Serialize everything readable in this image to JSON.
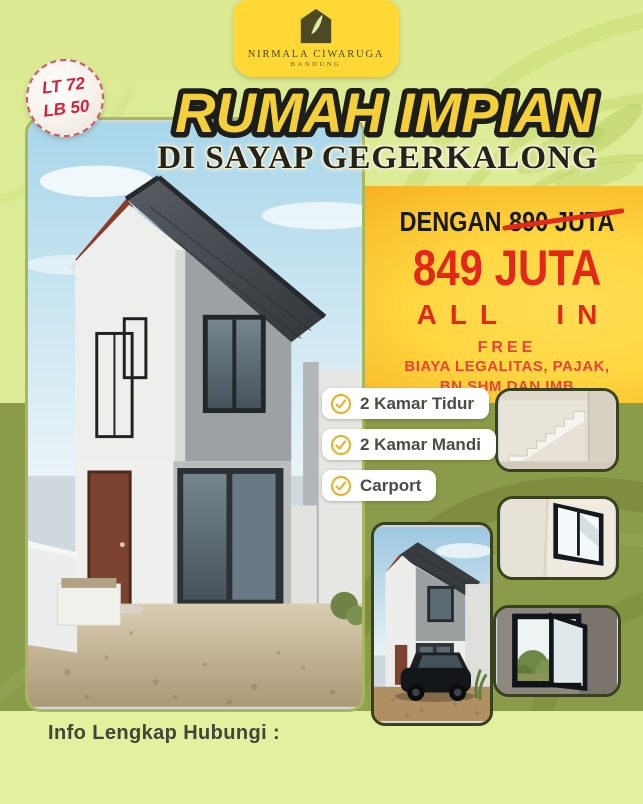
{
  "poster": {
    "badge": {
      "line1": "LT 72",
      "line2": "LB 50"
    },
    "logo": {
      "icon": "house-leaf-icon",
      "name": "NIRMALA CIWARUGA",
      "city": "BANDUNG"
    },
    "title": "RUMAH IMPIAN",
    "subtitle": "DI SAYAP GEGERKALONG",
    "offer": {
      "prefix": "DENGAN",
      "old_price": "890 JUTA",
      "new_price": "849 JUTA",
      "all_in": "ALL IN",
      "free_label": "FREE",
      "free_line1": "BIAYA LEGALITAS, PAJAK,",
      "free_line2": "BN SHM DAN IMB"
    },
    "features": [
      {
        "icon": "check-circle-icon",
        "label": "2 Kamar Tidur"
      },
      {
        "icon": "check-circle-icon",
        "label": "2 Kamar Mandi"
      },
      {
        "icon": "check-circle-icon",
        "label": "Carport"
      }
    ],
    "photos": {
      "main": "two-storey-house-exterior",
      "carport": "house-with-car-in-carport",
      "stairs": "interior-staircase",
      "window1": "bedroom-window",
      "window2": "open-window-with-garden-view"
    },
    "footer": {
      "contact_label": "Info Lengkap Hubungi :"
    },
    "colors": {
      "background_green": "#dcea94",
      "panel_yellow": "#ffd843",
      "panel_orange": "#f5a41d",
      "panel_olive": "#8a9b49",
      "price_red": "#e2281a",
      "title_yellow": "#f3cf3a",
      "badge_red": "#d4203a"
    }
  }
}
